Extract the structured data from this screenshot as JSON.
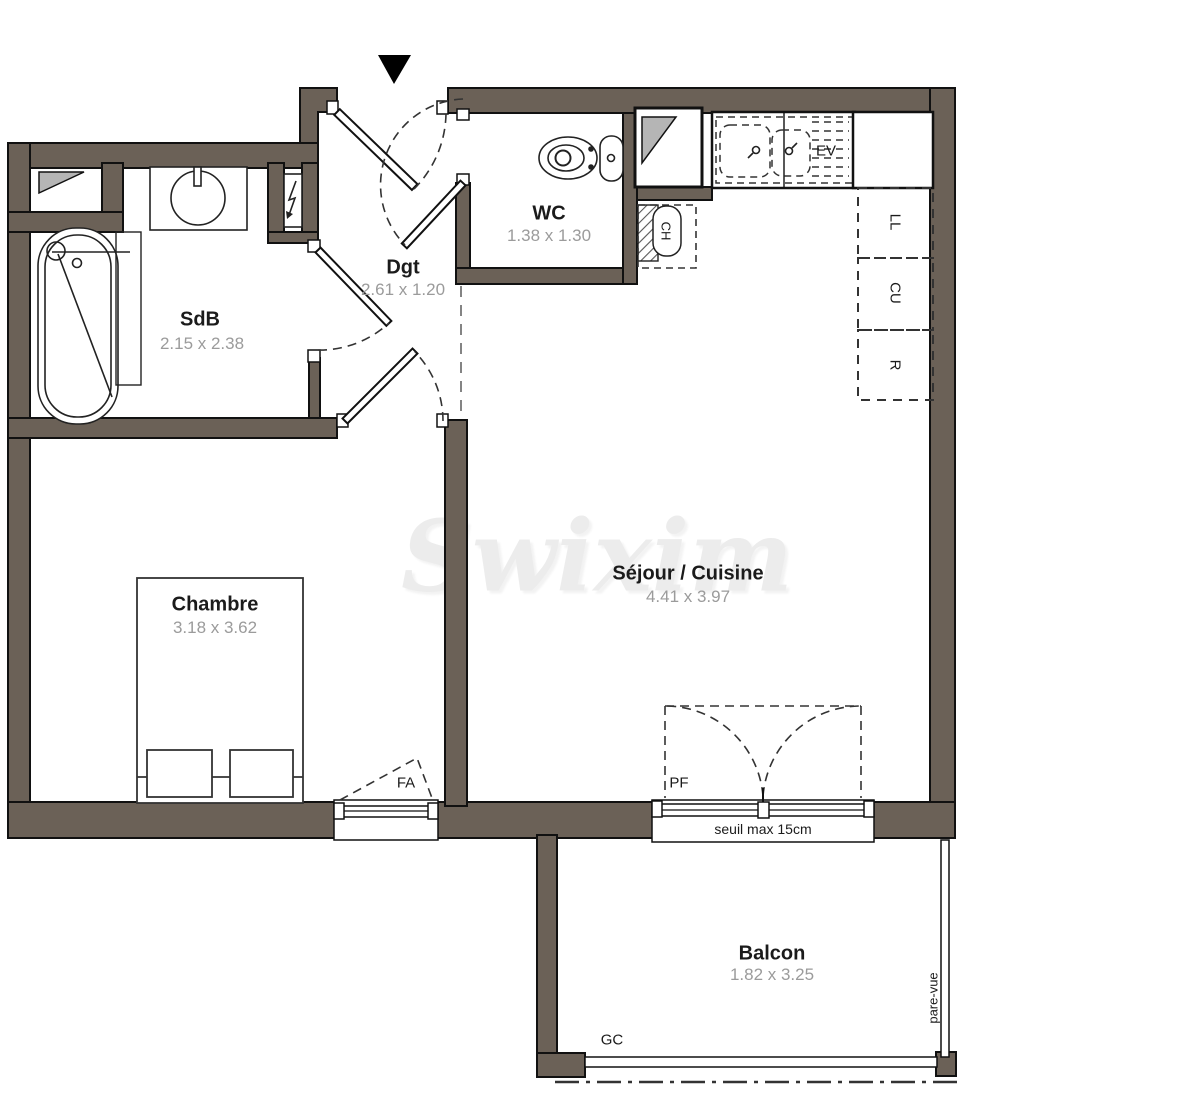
{
  "watermark": "Swixim",
  "rooms": {
    "sdb": {
      "name": "SdB",
      "dims": "2.15 x 2.38"
    },
    "dgt": {
      "name": "Dgt",
      "dims": "2.61 x 1.20"
    },
    "wc": {
      "name": "WC",
      "dims": "1.38 x 1.30"
    },
    "sejour": {
      "name": "Séjour / Cuisine",
      "dims": "4.41 x 3.97"
    },
    "chambre": {
      "name": "Chambre",
      "dims": "3.18 x 3.62"
    },
    "balcon": {
      "name": "Balcon",
      "dims": "1.82 x 3.25"
    }
  },
  "labels": {
    "sink": "EV",
    "water_heater": "CH",
    "washing_machine": "LL",
    "cooktop": "CU",
    "fridge": "R",
    "window_awning": "FA",
    "french_window": "PF",
    "guardrail": "GC",
    "threshold": "seuil max 15cm",
    "privacy_screen": "pare-vue"
  },
  "colors": {
    "wall": "#6b6157",
    "outline": "#111111",
    "dims_text": "#9b9b9b",
    "duct_fill": "#b5b5b5",
    "watermark": "#ececec"
  }
}
